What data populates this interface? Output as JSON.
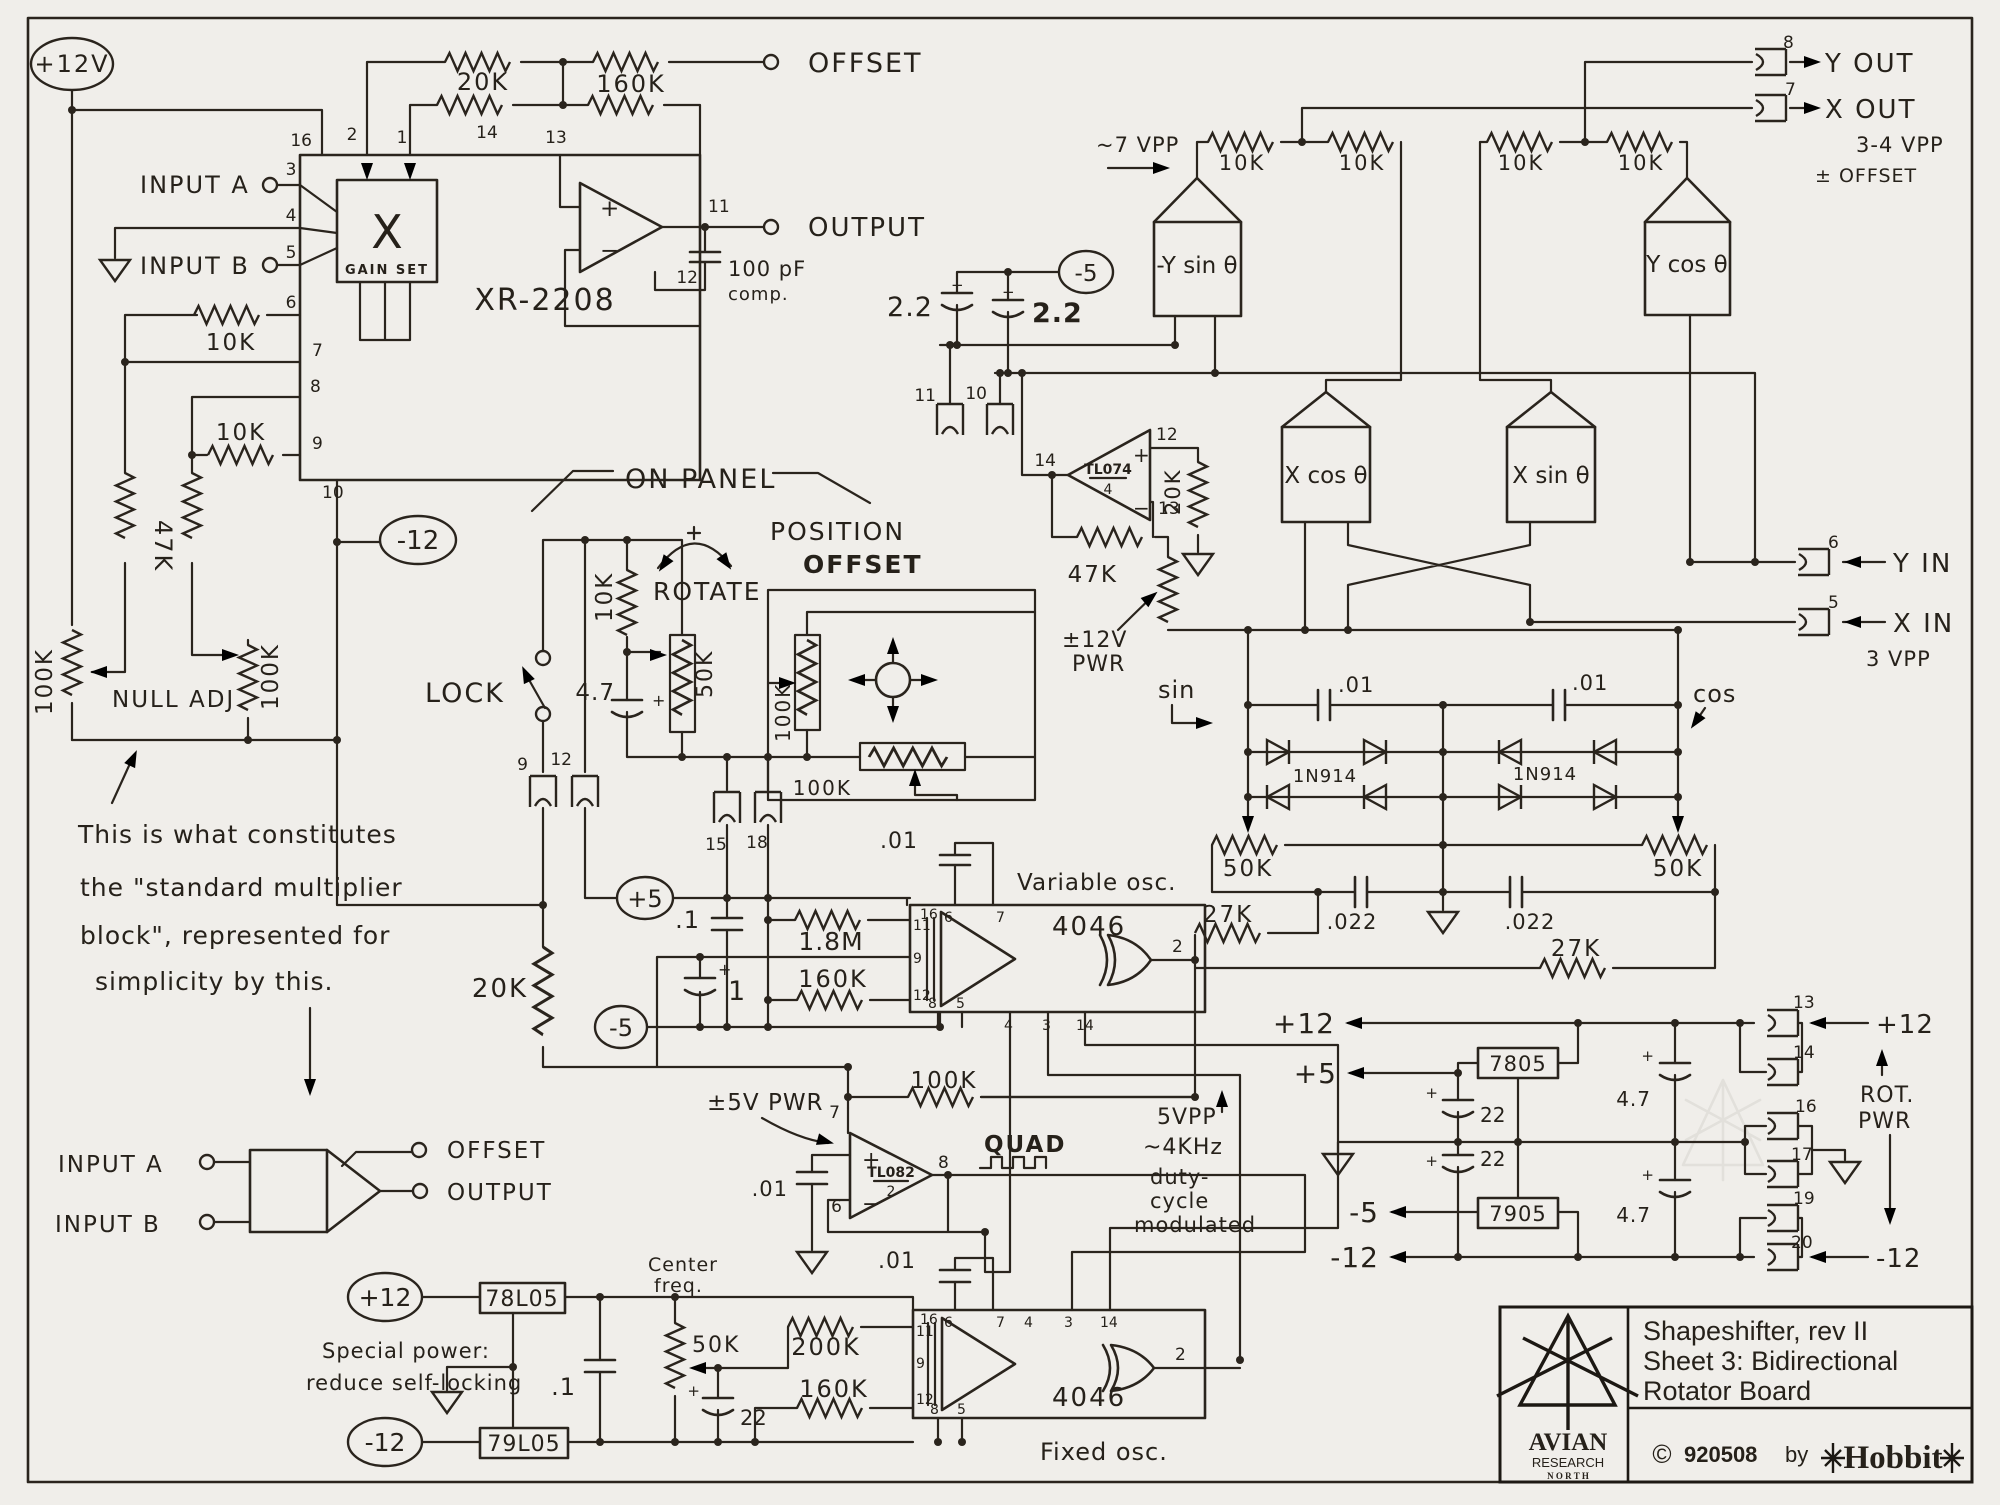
{
  "colors": {
    "paper": "#f0eeea",
    "ink": "#2a241d"
  },
  "xr": {
    "pwr12v": "+12V",
    "offset": "OFFSET",
    "r20k": "20K",
    "r160k": "160K",
    "input_a": "INPUT A",
    "input_b": "INPUT B",
    "x": "X",
    "gain_set": "GAIN SET",
    "chip": "XR-2208",
    "output": "OUTPUT",
    "c100pf": "100 pF",
    "comp": "comp.",
    "r10k_p6": "10K",
    "r10k_p9": "10K",
    "r47k": "47K",
    "pot100k_l": "100K",
    "pot100k_r": "100K",
    "null_adj": "NULL ADJ",
    "neg12": "-12",
    "p16": "16",
    "p2": "2",
    "p1": "1",
    "p14": "14",
    "p13": "13",
    "p3": "3",
    "p4": "4",
    "p5": "5",
    "p6": "6",
    "p7": "7",
    "p8": "8",
    "p9": "9",
    "p10": "10",
    "p11": "11",
    "p12": "12"
  },
  "note": {
    "l1": "This is what constitutes",
    "l2": "the \"standard multiplier",
    "l3": "block\", represented for",
    "l4": "simplicity by this.",
    "in_a": "INPUT A",
    "in_b": "INPUT B",
    "offset": "OFFSET",
    "output": "OUTPUT"
  },
  "panel": {
    "on_panel": "ON PANEL",
    "position": "POSITION",
    "offset": "OFFSET",
    "rotate": "ROTATE",
    "lock": "LOCK",
    "r10k": "10K",
    "c47": "4.7",
    "pot50k": "50K",
    "pot100k_v": "100K",
    "pot100k_h": "100K",
    "c9": "9",
    "c12": "12",
    "c15": "15",
    "c18": "18"
  },
  "varosc": {
    "plus5": "+5",
    "minus5": "-5",
    "c01": ".01",
    "cdot1": ".1",
    "c1": "1",
    "r18m": "1.8M",
    "r160k": "160K",
    "chip": "4046",
    "name": "Variable osc.",
    "r20k": "20K",
    "p16": "16",
    "p6": "6",
    "p7": "7",
    "p11": "11",
    "p9": "9",
    "p12": "12",
    "p8": "8",
    "p5": "5",
    "p4": "4",
    "p3": "3",
    "p14": "14",
    "p2": "2"
  },
  "tl082": {
    "pwr": "±5V PWR",
    "r100k": "100K",
    "name": "TL082",
    "den": "2",
    "quad": "QUAD",
    "p7": "7",
    "p6": "6",
    "p8": "8",
    "c01": ".01",
    "s1": "5VPP",
    "s2": "~4KHz",
    "s3": "duty-",
    "s4": "cycle",
    "s5": "modulated"
  },
  "fixed": {
    "plus12": "+12",
    "reg78": "78L05",
    "minus12": "-12",
    "reg79": "79L05",
    "special1": "Special power:",
    "special2": "reduce self-locking",
    "cdot1": ".1",
    "center1": "Center",
    "center2": "freq.",
    "pot50k": "50K",
    "c22": "22",
    "r200k": "200K",
    "r160k": "160K",
    "chip": "4046",
    "name": "Fixed osc.",
    "c01": ".01",
    "p16": "16",
    "p6": "6",
    "p7": "7",
    "p4": "4",
    "p3": "3",
    "p14": "14",
    "p11": "11",
    "p9": "9",
    "p12": "12",
    "p8": "8",
    "p5": "5",
    "p2": "2"
  },
  "rot": {
    "vpp7": "~7 VPP",
    "r10k_a": "10K",
    "r10k_b": "10K",
    "r10k_c": "10K",
    "r10k_d": "10K",
    "nysin": "-Y sin θ",
    "ycos": "Y cos θ",
    "xcos": "X cos θ",
    "xsin": "X sin θ",
    "yout": "Y OUT",
    "xout": "X OUT",
    "vpp34": "3-4 VPP",
    "pmoffset": "± OFFSET",
    "c22_a": "2.2",
    "c22_b": "2.2",
    "minus5": "-5",
    "c11": "11",
    "c10": "10",
    "c8": "8",
    "c7": "7",
    "c6": "6",
    "c5": "5",
    "tl074": "TL074",
    "den": "4",
    "p12": "12",
    "p13": "13",
    "p14": "14",
    "r20k": "20K",
    "r47k": "47K",
    "pwr1": "±12V",
    "pwr2": "PWR",
    "yin": "Y IN",
    "xin": "X IN",
    "vpp3": "3 VPP"
  },
  "sc": {
    "sin": "sin",
    "cos": "cos",
    "c01_a": ".01",
    "c01_b": ".01",
    "d_a": "1N914",
    "d_b": "1N914",
    "pot50k_a": "50K",
    "pot50k_b": "50K",
    "r27k_a": "27K",
    "r27k_b": "27K",
    "c022_a": ".022",
    "c022_b": ".022"
  },
  "pwr": {
    "p12out": "+12",
    "p5out": "+5",
    "m5out": "-5",
    "m12out": "-12",
    "reg7805": "7805",
    "reg7905": "7905",
    "c22a": "22",
    "c22b": "22",
    "c47a": "4.7",
    "c47b": "4.7",
    "c13": "13",
    "c14": "14",
    "c16": "16",
    "c17": "17",
    "c19": "19",
    "c20": "20",
    "p12in": "+12",
    "m12in": "-12",
    "rot1": "ROT.",
    "rot2": "PWR"
  },
  "title": {
    "l1": "Shapeshifter, rev II",
    "l2": "Sheet 3: Bidirectional",
    "l3": "Rotator Board",
    "copy": "©",
    "date": "920508",
    "by": "by",
    "author": "Hobbit",
    "org1": "AVIAN",
    "org2": "RESEARCH",
    "org3": "N O R T H"
  },
  "sym": {
    "plus": "+",
    "minus": "−"
  }
}
